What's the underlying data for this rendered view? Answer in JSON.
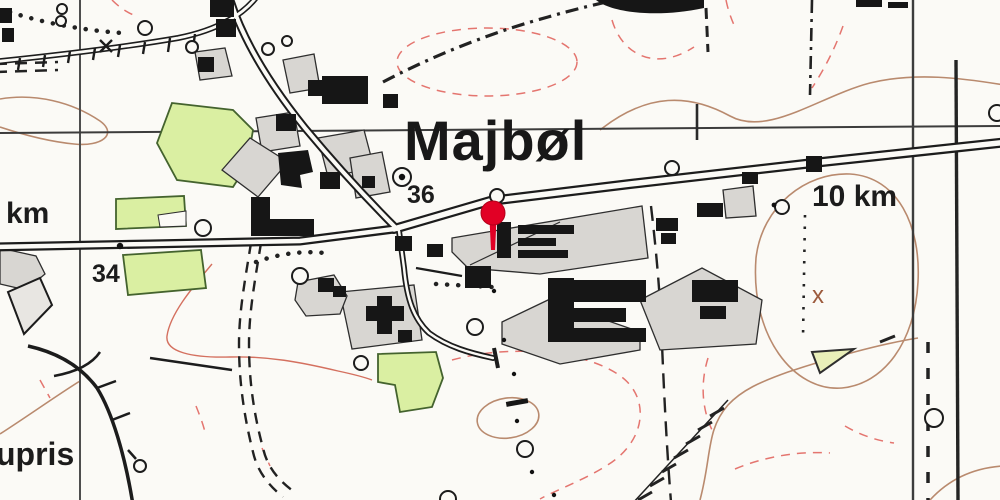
{
  "map": {
    "labels": {
      "place_name": "Majbøl",
      "spot_height": "36",
      "km_stone_west": "34",
      "left_edge_unit": "km",
      "km_stone_east": "10 km",
      "bottom_left_partial": "upris",
      "hill_cross_symbol": "x"
    },
    "marker": {
      "color": "#e10025",
      "edge_color": "#b3001a"
    },
    "colors": {
      "background": "#fbfaf6",
      "line_black": "#1c1c1c",
      "field_green": "#daefa2",
      "plot_gray": "#d8d6d2",
      "contour_brown": "#b98a6e",
      "contour_red_dashed": "#e4756f",
      "grid": "#3c3c3c"
    },
    "icons": {
      "location-pin": "map pin with round head",
      "circle-symbol": "open circle landmark",
      "spot-height-symbol": "circled dot",
      "km-post": "black square on road"
    }
  }
}
